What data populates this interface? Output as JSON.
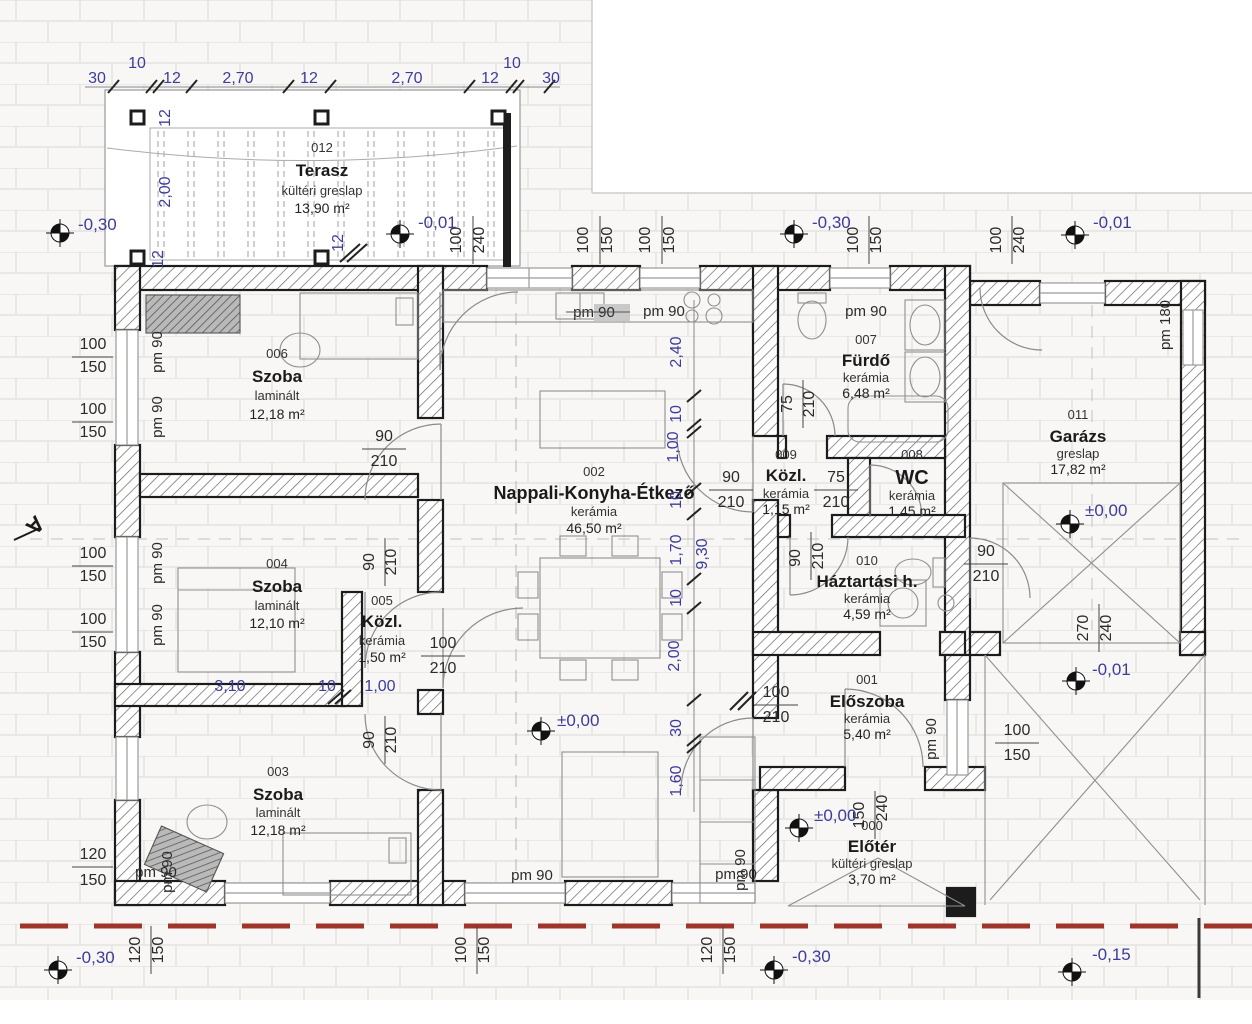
{
  "colors": {
    "dim_blue": "#3c3c9c",
    "wall_black": "#1c1c1c",
    "boundary_red": "#9e342a",
    "hatch_gray": "#666666",
    "grid_gray": "#e2dfda"
  },
  "section_mark": "A",
  "rooms": [
    {
      "num": "012",
      "name": "Terasz",
      "fin": "kültéri greslap",
      "area": "13,90 m²"
    },
    {
      "num": "006",
      "name": "Szoba",
      "fin": "laminált",
      "area": "12,18 m²"
    },
    {
      "num": "004",
      "name": "Szoba",
      "fin": "laminált",
      "area": "12,10 m²"
    },
    {
      "num": "005",
      "name": "Közl.",
      "fin": "kerámia",
      "area": "1,50 m²"
    },
    {
      "num": "003",
      "name": "Szoba",
      "fin": "laminált",
      "area": "12,18 m²"
    },
    {
      "num": "002",
      "name": "Nappali-Konyha-Étkező",
      "fin": "kerámia",
      "area": "46,50 m²"
    },
    {
      "num": "007",
      "name": "Fürdő",
      "fin": "kerámia",
      "area": "6,48 m²"
    },
    {
      "num": "009",
      "name": "Közl.",
      "fin": "kerámia",
      "area": "1,15 m²"
    },
    {
      "num": "008",
      "name": "WC",
      "fin": "kerámia",
      "area": "1,45 m²"
    },
    {
      "num": "010",
      "name": "Háztartási h.",
      "fin": "kerámia",
      "area": "4,59 m²"
    },
    {
      "num": "011",
      "name": "Garázs",
      "fin": "greslap",
      "area": "17,82 m²"
    },
    {
      "num": "001",
      "name": "Előszoba",
      "fin": "kerámia",
      "area": "5,40 m²"
    },
    {
      "num": "000",
      "name": "Előtér",
      "fin": "kültéri greslap",
      "area": "3,70 m²"
    }
  ],
  "levels": [
    {
      "t": "-0,30"
    },
    {
      "t": "-0,01"
    },
    {
      "t": "-0,30"
    },
    {
      "t": "-0,01"
    },
    {
      "t": "±0,00"
    },
    {
      "t": "±0,00"
    },
    {
      "t": "±0,00"
    },
    {
      "t": "-0,01"
    },
    {
      "t": "-0,30"
    },
    {
      "t": "-0,30"
    },
    {
      "t": "-0,15"
    }
  ],
  "blue": [
    {
      "t": "30"
    },
    {
      "t": "10"
    },
    {
      "t": "12"
    },
    {
      "t": "2,70"
    },
    {
      "t": "12"
    },
    {
      "t": "2,70"
    },
    {
      "t": "12"
    },
    {
      "t": "10"
    },
    {
      "t": "30"
    },
    {
      "t": "12"
    },
    {
      "t": "2,00"
    },
    {
      "t": "12"
    },
    {
      "t": "12"
    },
    {
      "t": "2,40"
    },
    {
      "t": "10"
    },
    {
      "t": "1,00"
    },
    {
      "t": "10"
    },
    {
      "t": "1,70"
    },
    {
      "t": "9,30"
    },
    {
      "t": "10"
    },
    {
      "t": "2,00"
    },
    {
      "t": "30"
    },
    {
      "t": "1,60"
    },
    {
      "t": "3,10"
    },
    {
      "t": "10"
    },
    {
      "t": "1,00"
    }
  ],
  "black": [
    {
      "t": "100"
    },
    {
      "t": "150"
    },
    {
      "t": "100"
    },
    {
      "t": "150"
    },
    {
      "t": "100"
    },
    {
      "t": "150"
    },
    {
      "t": "100"
    },
    {
      "t": "150"
    },
    {
      "t": "120"
    },
    {
      "t": "150"
    },
    {
      "t": "100"
    },
    {
      "t": "240"
    },
    {
      "t": "100"
    },
    {
      "t": "150"
    },
    {
      "t": "100"
    },
    {
      "t": "150"
    },
    {
      "t": "100"
    },
    {
      "t": "150"
    },
    {
      "t": "100"
    },
    {
      "t": "240"
    },
    {
      "t": "120"
    },
    {
      "t": "150"
    },
    {
      "t": "100"
    },
    {
      "t": "150"
    },
    {
      "t": "120"
    },
    {
      "t": "150"
    },
    {
      "t": "90"
    },
    {
      "t": "210"
    },
    {
      "t": "100"
    },
    {
      "t": "210"
    },
    {
      "t": "90"
    },
    {
      "t": "210"
    },
    {
      "t": "75"
    },
    {
      "t": "210"
    },
    {
      "t": "90"
    },
    {
      "t": "210"
    },
    {
      "t": "100"
    },
    {
      "t": "210"
    },
    {
      "t": "100"
    },
    {
      "t": "150"
    },
    {
      "t": "90"
    },
    {
      "t": "210"
    },
    {
      "t": "90"
    },
    {
      "t": "210"
    },
    {
      "t": "75"
    },
    {
      "t": "210"
    },
    {
      "t": "90"
    },
    {
      "t": "210"
    },
    {
      "t": "150"
    },
    {
      "t": "240"
    },
    {
      "t": "270"
    },
    {
      "t": "240"
    }
  ],
  "pm": [
    {
      "t": "pm 90"
    },
    {
      "t": "pm 90"
    },
    {
      "t": "pm 90"
    },
    {
      "t": "pm 90"
    },
    {
      "t": "pm 90"
    },
    {
      "t": "pm 90"
    },
    {
      "t": "pm 90"
    },
    {
      "t": "pm 180"
    },
    {
      "t": "pm 90"
    },
    {
      "t": "pm 90"
    },
    {
      "t": "pm 90"
    },
    {
      "t": "pm 90"
    },
    {
      "t": "pm 90"
    },
    {
      "t": "pm 90"
    }
  ]
}
